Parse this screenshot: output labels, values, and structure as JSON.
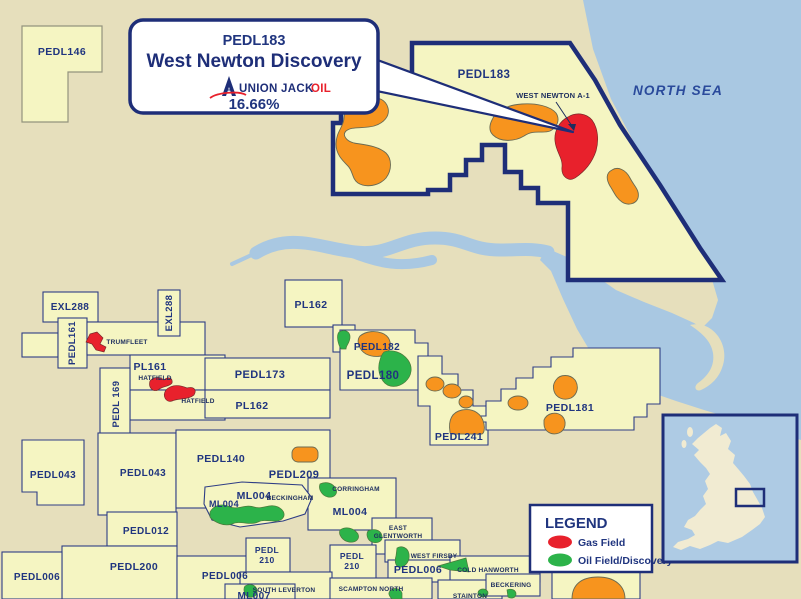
{
  "callout": {
    "licence": "PEDL183",
    "title": "West Newton Discovery",
    "company": "UNION JACK",
    "company_oil": "OIL",
    "interest": "16.66%"
  },
  "sea_label": "NORTH SEA",
  "licences": {
    "pedl146": "PEDL146",
    "pedl183_map": "PEDL183",
    "exl288_a": "EXL288",
    "exl288_b": "EXL288",
    "pedl161": "PEDL161",
    "pl161": "PL161",
    "pedl169": "PEDL 169",
    "pedl173": "PEDL173",
    "pl162_a": "PL162",
    "pl162_b": "PL162",
    "pedl182": "PEDL182",
    "pedl180": "PEDL180",
    "pedl181": "PEDL181",
    "pedl241": "PEDL241",
    "pedl140": "PEDL140",
    "pedl209": "PEDL209",
    "pedl043_a": "PEDL043",
    "pedl043_b": "PEDL043",
    "pedl012": "PEDL012",
    "pedl200": "PEDL200",
    "pedl006_a": "PEDL006",
    "pedl006_b": "PEDL006",
    "pedl006_c": "PEDL006",
    "ml004_a": "ML004",
    "ml004_b": "ML004",
    "ml004_c": "ML004",
    "ml007": "ML007",
    "pedl210_a": [
      "PEDL",
      "210"
    ],
    "pedl210_b": [
      "PEDL",
      "210"
    ]
  },
  "fields": {
    "west_newton_well": "WEST NEWTON A-1",
    "trumfleet": "TRUMFLEET",
    "hatfield_a": "HATFIELD",
    "hatfield_b": "HATFIELD",
    "beckingham": "BECKINGHAM",
    "corringham": "CORRINGHAM",
    "east_glentworth": [
      "EAST",
      "GLENTWORTH"
    ],
    "west_firsby": "WEST FIRSBY",
    "cold_hanworth": "COLD HANWORTH",
    "beckering": "BECKERING",
    "south_leverton": "SOUTH LEVERTON",
    "scampton_north": "SCAMPTON NORTH",
    "stainton": "STAINTON"
  },
  "legend": {
    "title": "LEGEND",
    "items": [
      {
        "label": "Gas Field",
        "color": "#e8212c"
      },
      {
        "label": "Oil Field/Discovery",
        "color": "#2cb34a"
      }
    ]
  },
  "colors": {
    "background_land": "#e6dfbc",
    "licence_fill": "#f5f5c2",
    "sea": "#a9c8e2",
    "navy_border": "#1e2e78",
    "gas_field_red": "#e8212c",
    "oil_field_green": "#2cb34a",
    "orange_field": "#f7941e"
  }
}
